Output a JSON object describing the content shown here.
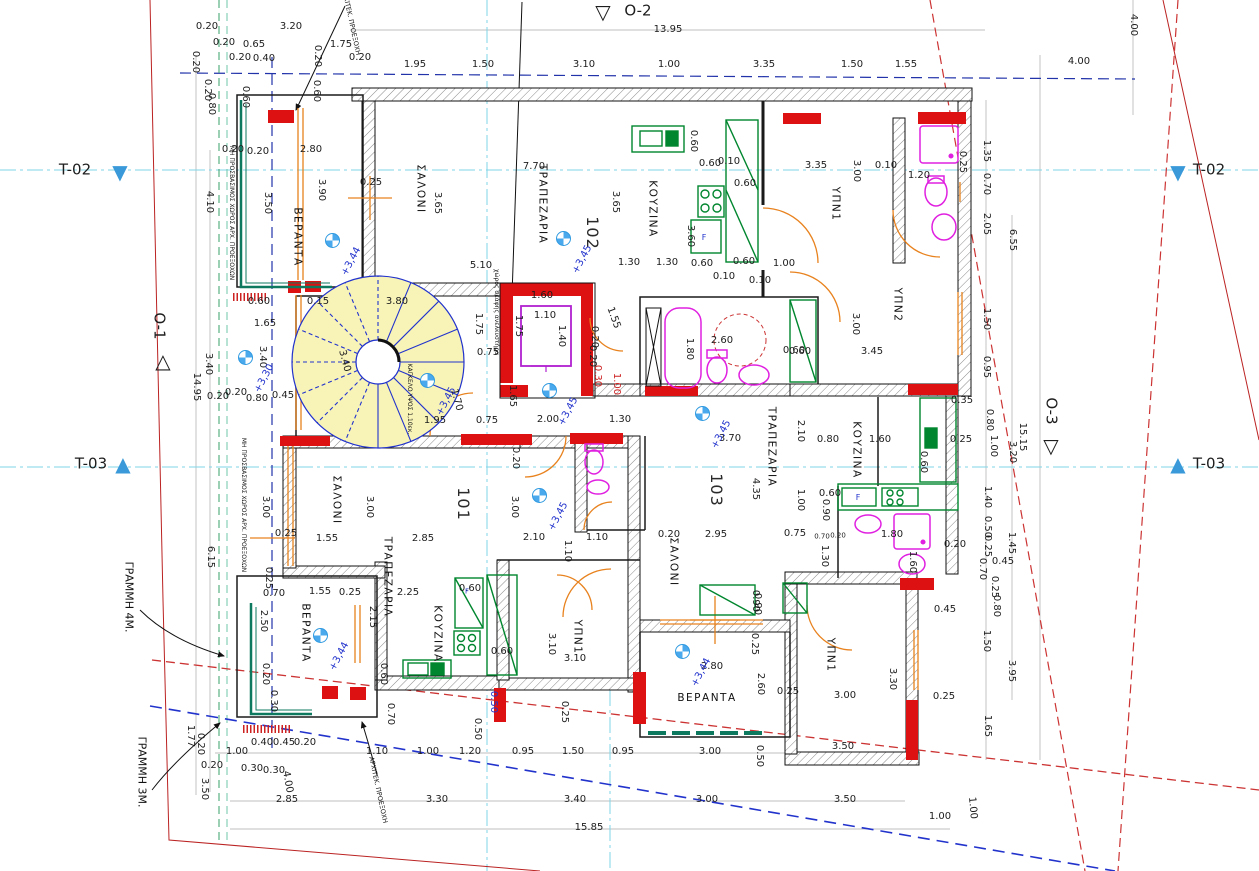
{
  "drawing": {
    "type": "architectural-floor-plan",
    "grammh_4m_label": "ΓΡΑΜΜΗ 4Μ.",
    "grammh_3m_label": "ΓΡΑΜΜΗ 3Μ."
  },
  "colors": {
    "wall_red": "#dd1111",
    "stair_yellow": "#f8f4b8",
    "stair_blue": "#2233cc",
    "fixture_magenta": "#e020e0",
    "kitchen_green": "#00862e",
    "door_orange": "#e8821e",
    "axis_cyan": "#7fd4e8",
    "boundary_red": "#cc3333",
    "line_blue": "#2233cc",
    "teal_rail": "#0d7a5f",
    "marker_blue": "#3a9ad9"
  },
  "units": [
    {
      "number": "101",
      "rooms": [
        "ΣΑΛΟΝΙ",
        "ΤΡΑΠΕΖΑΡΙΑ",
        "ΚΟΥΖΙΝΑ",
        "ΥΠΝ1",
        "ΒΕΡΑΝΤΑ"
      ]
    },
    {
      "number": "102",
      "rooms": [
        "ΒΕΡΑΝΤΑ",
        "ΣΑΛΟΝΙ",
        "ΤΡΑΠΕΖΑΡΙΑ",
        "ΚΟΥΖΙΝΑ",
        "ΥΠΝ1",
        "ΥΠΝ2"
      ]
    },
    {
      "number": "103",
      "rooms": [
        "ΣΑΛΟΝΙ",
        "ΤΡΑΠΕΖΑΡΙΑ",
        "ΚΟΥΖΙΝΑ",
        "ΥΠΝ1",
        "ΒΕΡΑΝΤΑ"
      ]
    }
  ],
  "markers": [
    {
      "t": "T-02",
      "x": 75,
      "y": 170,
      "g": "▼",
      "gx": 120,
      "gy": 172,
      "gc": "#3a9ad9"
    },
    {
      "t": "T-02",
      "x": 1209,
      "y": 170,
      "g": "▼",
      "gx": 1178,
      "gy": 172,
      "gc": "#3a9ad9"
    },
    {
      "t": "T-03",
      "x": 91,
      "y": 464,
      "g": "▲",
      "gx": 123,
      "gy": 464,
      "gc": "#3a9ad9"
    },
    {
      "t": "T-03",
      "x": 1209,
      "y": 464,
      "g": "▲",
      "gx": 1178,
      "gy": 464,
      "gc": "#3a9ad9"
    },
    {
      "t": "O-2",
      "x": 638,
      "y": 11,
      "g": "▽",
      "gx": 603,
      "gy": 12,
      "gc": "#1d1d1d"
    },
    {
      "t": "O-1",
      "x": 159,
      "y": 326,
      "r": 90,
      "g": "△",
      "gx": 163,
      "gy": 361,
      "gc": "#1d1d1d"
    },
    {
      "t": "O-3",
      "x": 1051,
      "y": 411,
      "r": 90,
      "g": "▽",
      "gx": 1051,
      "gy": 446,
      "gc": "#1d1d1d"
    }
  ],
  "unit_labels": [
    {
      "t": "102",
      "x": 592,
      "y": 233,
      "r": 90
    },
    {
      "t": "101",
      "x": 463,
      "y": 504,
      "r": 90
    },
    {
      "t": "103",
      "x": 716,
      "y": 490,
      "r": 90
    }
  ],
  "room_labels": [
    {
      "t": "ΒΕΡΑΝΤΑ",
      "x": 297,
      "y": 237,
      "r": 90
    },
    {
      "t": "ΣΑΛΟΝΙ",
      "x": 420,
      "y": 189,
      "r": 90
    },
    {
      "t": "ΤΡΑΠΕΖΑΡΙΑ",
      "x": 542,
      "y": 204,
      "r": 90
    },
    {
      "t": "ΚΟΥΖΙΝΑ",
      "x": 652,
      "y": 209,
      "r": 90
    },
    {
      "t": "ΥΠΝ1",
      "x": 835,
      "y": 204,
      "r": 90
    },
    {
      "t": "ΥΠΝ2",
      "x": 897,
      "y": 305,
      "r": 90
    },
    {
      "t": "ΣΑΛΟΝΙ",
      "x": 336,
      "y": 500,
      "r": 90
    },
    {
      "t": "ΤΡΑΠΕΖΑΡΙΑ",
      "x": 387,
      "y": 577,
      "r": 90
    },
    {
      "t": "ΚΟΥΖΙΝΑ",
      "x": 437,
      "y": 634,
      "r": 90
    },
    {
      "t": "ΥΠΝ1",
      "x": 577,
      "y": 637,
      "r": 90
    },
    {
      "t": "ΒΕΡΑΝΤΑ",
      "x": 305,
      "y": 633,
      "r": 90
    },
    {
      "t": "ΣΑΛΟΝΙ",
      "x": 673,
      "y": 562,
      "r": 90
    },
    {
      "t": "ΤΡΑΠΕΖΑΡΙΑ",
      "x": 771,
      "y": 447,
      "r": 90
    },
    {
      "t": "ΚΟΥΖΙΝΑ",
      "x": 856,
      "y": 450,
      "r": 90
    },
    {
      "t": "ΥΠΝ1",
      "x": 830,
      "y": 655,
      "r": 90
    },
    {
      "t": "ΒΕΡΑΝΤΑ",
      "x": 707,
      "y": 698
    }
  ],
  "elevation_points": [
    {
      "t": "+3,44",
      "x": 332,
      "y": 240
    },
    {
      "t": "+3,45",
      "x": 563,
      "y": 238
    },
    {
      "t": "+3,45",
      "x": 427,
      "y": 380
    },
    {
      "t": "+3,45",
      "x": 549,
      "y": 390
    },
    {
      "t": "+3,45",
      "x": 702,
      "y": 413
    },
    {
      "t": "+3,45",
      "x": 539,
      "y": 495
    },
    {
      "t": "+3,44",
      "x": 320,
      "y": 635
    },
    {
      "t": "+3,44",
      "x": 682,
      "y": 651
    },
    {
      "t": "+3,30",
      "x": 245,
      "y": 357
    }
  ],
  "notes": [
    {
      "t": "ΓΡΑΜΜΗ 4Μ.",
      "x": 129,
      "y": 597,
      "r": 90,
      "s": 11
    },
    {
      "t": "ΓΡΑΜΜΗ 3Μ.",
      "x": 142,
      "y": 772,
      "r": 90,
      "s": 11
    },
    {
      "t": "ΑΡΧΙΤΕΚ. ΠΡΟΕΞΟΧΗ",
      "x": 351,
      "y": 22,
      "r": 78,
      "s": 6.5
    },
    {
      "t": "ΑΡΧΙΤΕΚ. ΠΡΟΕΞΟΧΗ",
      "x": 378,
      "y": 790,
      "r": 78,
      "s": 6.5
    },
    {
      "t": "ΜΗ ΠΡΟΣΒΑΣΙΜΟΣ ΧΩΡΟΣ ΑΡΧ. ΠΡΟΕΞΟΧΩΝ",
      "x": 231,
      "y": 213,
      "r": 90,
      "s": 6
    },
    {
      "t": "ΜΗ ΠΡΟΣΒΑΣΙΜΟΣ ΧΩΡΟΣ ΑΡΧ. ΠΡΟΕΞΟΧΩΝ",
      "x": 243,
      "y": 505,
      "r": 90,
      "s": 6
    },
    {
      "t": "χώρος σκάφης ανελκυστήρα",
      "x": 496,
      "y": 312,
      "r": 90,
      "s": 6
    },
    {
      "t": "ΚΑΓΚΕΛΟ ΥΨΟΣ 1,10εκ.",
      "x": 409,
      "y": 399,
      "r": 90,
      "s": 6
    },
    {
      "t": "F",
      "x": 704,
      "y": 238,
      "s": 8,
      "c": "#2233cc"
    },
    {
      "t": "F",
      "x": 858,
      "y": 498,
      "s": 8,
      "c": "#2233cc"
    },
    {
      "t": "F",
      "x": 467,
      "y": 592,
      "s": 7,
      "c": "#2233cc"
    }
  ],
  "dimensions": [
    {
      "t": "13.95",
      "x": 668,
      "y": 30
    },
    {
      "t": "0.20",
      "x": 207,
      "y": 27
    },
    {
      "t": "3.20",
      "x": 291,
      "y": 27
    },
    {
      "t": "0.20",
      "x": 224,
      "y": 43
    },
    {
      "t": "0.65",
      "x": 254,
      "y": 45
    },
    {
      "t": "1.75",
      "x": 341,
      "y": 45
    },
    {
      "t": "0.20",
      "x": 240,
      "y": 58
    },
    {
      "t": "0.40",
      "x": 264,
      "y": 59
    },
    {
      "t": "0.20",
      "x": 317,
      "y": 56,
      "r": 90
    },
    {
      "t": "0.20",
      "x": 360,
      "y": 58
    },
    {
      "t": "1.95",
      "x": 415,
      "y": 65
    },
    {
      "t": "1.50",
      "x": 483,
      "y": 65
    },
    {
      "t": "3.10",
      "x": 584,
      "y": 65
    },
    {
      "t": "1.00",
      "x": 669,
      "y": 65
    },
    {
      "t": "3.35",
      "x": 764,
      "y": 65
    },
    {
      "t": "1.50",
      "x": 852,
      "y": 65
    },
    {
      "t": "1.55",
      "x": 906,
      "y": 65
    },
    {
      "t": "4.00",
      "x": 1079,
      "y": 62
    },
    {
      "t": "4.00",
      "x": 1133,
      "y": 25,
      "r": 90
    },
    {
      "t": "0.20",
      "x": 195,
      "y": 62,
      "r": 90
    },
    {
      "t": "0.20",
      "x": 207,
      "y": 90,
      "r": 90
    },
    {
      "t": "0.80",
      "x": 211,
      "y": 104,
      "r": 90
    },
    {
      "t": "0.60",
      "x": 245,
      "y": 97,
      "r": 90
    },
    {
      "t": "0.60",
      "x": 316,
      "y": 91,
      "r": 90
    },
    {
      "t": "0.20",
      "x": 233,
      "y": 150
    },
    {
      "t": "0.20",
      "x": 258,
      "y": 152
    },
    {
      "t": "2.80",
      "x": 311,
      "y": 150
    },
    {
      "t": "4.10",
      "x": 209,
      "y": 202,
      "r": 90
    },
    {
      "t": "3.50",
      "x": 267,
      "y": 203,
      "r": 90
    },
    {
      "t": "3.90",
      "x": 321,
      "y": 190,
      "r": 90
    },
    {
      "t": "0.25",
      "x": 371,
      "y": 183
    },
    {
      "t": "3.65",
      "x": 437,
      "y": 203,
      "r": 90
    },
    {
      "t": "7.70",
      "x": 534,
      "y": 167
    },
    {
      "t": "3.65",
      "x": 615,
      "y": 202,
      "r": 90
    },
    {
      "t": "3.60",
      "x": 690,
      "y": 236,
      "r": 90
    },
    {
      "t": "5.10",
      "x": 481,
      "y": 266
    },
    {
      "t": "0.60",
      "x": 710,
      "y": 164
    },
    {
      "t": "0.10",
      "x": 729,
      "y": 162
    },
    {
      "t": "0.60",
      "x": 745,
      "y": 184
    },
    {
      "t": "0.60",
      "x": 693,
      "y": 141,
      "r": 90
    },
    {
      "t": "3.35",
      "x": 816,
      "y": 166
    },
    {
      "t": "3.00",
      "x": 856,
      "y": 171,
      "r": 90
    },
    {
      "t": "0.10",
      "x": 886,
      "y": 166
    },
    {
      "t": "1.20",
      "x": 919,
      "y": 176
    },
    {
      "t": "0.25",
      "x": 962,
      "y": 162,
      "r": 90
    },
    {
      "t": "1.30",
      "x": 629,
      "y": 263
    },
    {
      "t": "1.30",
      "x": 667,
      "y": 263
    },
    {
      "t": "0.60",
      "x": 702,
      "y": 264
    },
    {
      "t": "0.60",
      "x": 744,
      "y": 262
    },
    {
      "t": "1.00",
      "x": 784,
      "y": 264
    },
    {
      "t": "0.10",
      "x": 724,
      "y": 277
    },
    {
      "t": "0.10",
      "x": 760,
      "y": 281
    },
    {
      "t": "1.35",
      "x": 986,
      "y": 151,
      "r": 90
    },
    {
      "t": "0.70",
      "x": 986,
      "y": 184,
      "r": 90
    },
    {
      "t": "2.05",
      "x": 986,
      "y": 224,
      "r": 90
    },
    {
      "t": "6.55",
      "x": 1012,
      "y": 240,
      "r": 90
    },
    {
      "t": "1.50",
      "x": 986,
      "y": 319,
      "r": 90
    },
    {
      "t": "0.95",
      "x": 986,
      "y": 367,
      "r": 90
    },
    {
      "t": "0.35",
      "x": 962,
      "y": 401
    },
    {
      "t": "0.80",
      "x": 989,
      "y": 420,
      "r": 90
    },
    {
      "t": "1.00",
      "x": 993,
      "y": 446,
      "r": 90
    },
    {
      "t": "15.15",
      "x": 1022,
      "y": 437,
      "r": 90
    },
    {
      "t": "3.20",
      "x": 1012,
      "y": 452,
      "r": 90
    },
    {
      "t": "0.15",
      "x": 318,
      "y": 302
    },
    {
      "t": "3.80",
      "x": 397,
      "y": 302
    },
    {
      "t": "3.40",
      "x": 344,
      "y": 361,
      "r": 75
    },
    {
      "t": "1.75",
      "x": 478,
      "y": 324,
      "r": 90
    },
    {
      "t": "0.75",
      "x": 488,
      "y": 353
    },
    {
      "t": "1.70",
      "x": 456,
      "y": 400,
      "r": 75
    },
    {
      "t": "1.95",
      "x": 435,
      "y": 421
    },
    {
      "t": "0.75",
      "x": 487,
      "y": 421
    },
    {
      "t": "1.65",
      "x": 512,
      "y": 396,
      "r": 90
    },
    {
      "t": "1.60",
      "x": 542,
      "y": 296
    },
    {
      "t": "1.10",
      "x": 545,
      "y": 316
    },
    {
      "t": "1.40",
      "x": 561,
      "y": 336,
      "r": 90
    },
    {
      "t": "1.75",
      "x": 518,
      "y": 326,
      "r": 90
    },
    {
      "t": "1.55",
      "x": 613,
      "y": 318,
      "r": 70
    },
    {
      "t": "0.20",
      "x": 594,
      "y": 337,
      "r": 90
    },
    {
      "t": "0.20",
      "x": 592,
      "y": 356,
      "r": 90
    },
    {
      "t": "0.30",
      "x": 597,
      "y": 376,
      "r": 90,
      "c": "#cc2222"
    },
    {
      "t": "1.00",
      "x": 616,
      "y": 384,
      "r": 90,
      "c": "#cc2222"
    },
    {
      "t": "2.00",
      "x": 548,
      "y": 420
    },
    {
      "t": "1.30",
      "x": 620,
      "y": 420
    },
    {
      "t": "0.20",
      "x": 515,
      "y": 458,
      "r": 90
    },
    {
      "t": "1.80",
      "x": 689,
      "y": 349,
      "r": 90
    },
    {
      "t": "2.60",
      "x": 722,
      "y": 341
    },
    {
      "t": "0.60",
      "x": 794,
      "y": 351
    },
    {
      "t": "3.00",
      "x": 855,
      "y": 324,
      "r": 90
    },
    {
      "t": "3.45",
      "x": 872,
      "y": 352
    },
    {
      "t": "0.60",
      "x": 800,
      "y": 352
    },
    {
      "t": "0.60",
      "x": 259,
      "y": 302
    },
    {
      "t": "1.65",
      "x": 265,
      "y": 324
    },
    {
      "t": "3.40",
      "x": 208,
      "y": 364,
      "r": 90
    },
    {
      "t": "3.40",
      "x": 262,
      "y": 357,
      "r": 90
    },
    {
      "t": "14.95",
      "x": 196,
      "y": 387,
      "r": 90
    },
    {
      "t": "0.20",
      "x": 218,
      "y": 397
    },
    {
      "t": "0.20",
      "x": 236,
      "y": 393
    },
    {
      "t": "0.80",
      "x": 257,
      "y": 399
    },
    {
      "t": "0.45",
      "x": 283,
      "y": 396
    },
    {
      "t": "6.15",
      "x": 210,
      "y": 557,
      "r": 90
    },
    {
      "t": "3.00",
      "x": 265,
      "y": 507,
      "r": 90
    },
    {
      "t": "3.00",
      "x": 369,
      "y": 507,
      "r": 90
    },
    {
      "t": "3.00",
      "x": 514,
      "y": 507,
      "r": 90
    },
    {
      "t": "0.25",
      "x": 286,
      "y": 534
    },
    {
      "t": "1.55",
      "x": 327,
      "y": 539
    },
    {
      "t": "2.85",
      "x": 423,
      "y": 539
    },
    {
      "t": "2.10",
      "x": 534,
      "y": 538
    },
    {
      "t": "1.10",
      "x": 597,
      "y": 538
    },
    {
      "t": "1.10",
      "x": 567,
      "y": 551,
      "r": 90
    },
    {
      "t": "0.25",
      "x": 268,
      "y": 578,
      "r": 90
    },
    {
      "t": "0.70",
      "x": 274,
      "y": 594
    },
    {
      "t": "1.55",
      "x": 320,
      "y": 592
    },
    {
      "t": "0.25",
      "x": 350,
      "y": 593
    },
    {
      "t": "2.25",
      "x": 408,
      "y": 593
    },
    {
      "t": "0.60",
      "x": 470,
      "y": 589
    },
    {
      "t": "3.70",
      "x": 730,
      "y": 439
    },
    {
      "t": "2.10",
      "x": 800,
      "y": 431,
      "r": 90
    },
    {
      "t": "0.80",
      "x": 828,
      "y": 440
    },
    {
      "t": "1.60",
      "x": 880,
      "y": 440
    },
    {
      "t": "0.25",
      "x": 961,
      "y": 440
    },
    {
      "t": "0.60",
      "x": 923,
      "y": 462,
      "r": 90
    },
    {
      "t": "4.35",
      "x": 755,
      "y": 489,
      "r": 90
    },
    {
      "t": "1.00",
      "x": 800,
      "y": 500,
      "r": 90
    },
    {
      "t": "0.60",
      "x": 830,
      "y": 494
    },
    {
      "t": "0.90",
      "x": 825,
      "y": 510,
      "r": 90
    },
    {
      "t": "0.20",
      "x": 669,
      "y": 535
    },
    {
      "t": "2.95",
      "x": 716,
      "y": 535
    },
    {
      "t": "0.75",
      "x": 795,
      "y": 534
    },
    {
      "t": "0.70",
      "x": 822,
      "y": 537,
      "s": 7
    },
    {
      "t": "0.20",
      "x": 838,
      "y": 536,
      "s": 7
    },
    {
      "t": "1.30",
      "x": 824,
      "y": 556,
      "r": 90
    },
    {
      "t": "1.80",
      "x": 892,
      "y": 535
    },
    {
      "t": "1.60",
      "x": 912,
      "y": 562,
      "r": 90
    },
    {
      "t": "0.20",
      "x": 955,
      "y": 545
    },
    {
      "t": "0.90",
      "x": 755,
      "y": 601,
      "r": 90
    },
    {
      "t": "0.45",
      "x": 945,
      "y": 610
    },
    {
      "t": "1.40",
      "x": 987,
      "y": 497,
      "r": 90
    },
    {
      "t": "0.50",
      "x": 987,
      "y": 527,
      "r": 90
    },
    {
      "t": "0.25",
      "x": 987,
      "y": 546,
      "r": 90
    },
    {
      "t": "1.45",
      "x": 1011,
      "y": 543,
      "r": 90
    },
    {
      "t": "0.70",
      "x": 982,
      "y": 569,
      "r": 90
    },
    {
      "t": "0.25",
      "x": 994,
      "y": 587,
      "r": 90
    },
    {
      "t": "0.80",
      "x": 996,
      "y": 606,
      "r": 90
    },
    {
      "t": "1.50",
      "x": 986,
      "y": 641,
      "r": 90
    },
    {
      "t": "3.95",
      "x": 1011,
      "y": 671,
      "r": 90
    },
    {
      "t": "1.65",
      "x": 987,
      "y": 726,
      "r": 90
    },
    {
      "t": "0.45",
      "x": 1003,
      "y": 562
    },
    {
      "t": "2.50",
      "x": 263,
      "y": 621,
      "r": 90
    },
    {
      "t": "2.15",
      "x": 372,
      "y": 617,
      "r": 90
    },
    {
      "t": "0.60",
      "x": 502,
      "y": 652
    },
    {
      "t": "0.60",
      "x": 383,
      "y": 674,
      "r": 90
    },
    {
      "t": "0.20",
      "x": 265,
      "y": 674,
      "r": 90
    },
    {
      "t": "0.30",
      "x": 273,
      "y": 701,
      "r": 90
    },
    {
      "t": "0.70",
      "x": 390,
      "y": 714,
      "r": 90
    },
    {
      "t": "0.50",
      "x": 493,
      "y": 702,
      "r": 90,
      "c": "#2233cc"
    },
    {
      "t": "3.10",
      "x": 551,
      "y": 644,
      "r": 90
    },
    {
      "t": "3.10",
      "x": 575,
      "y": 659
    },
    {
      "t": "0.25",
      "x": 564,
      "y": 712,
      "r": 90
    },
    {
      "t": "0.90",
      "x": 757,
      "y": 604,
      "r": 90
    },
    {
      "t": "0.25",
      "x": 754,
      "y": 644,
      "r": 90
    },
    {
      "t": "2.80",
      "x": 712,
      "y": 667
    },
    {
      "t": "2.60",
      "x": 760,
      "y": 684,
      "r": 90
    },
    {
      "t": "0.25",
      "x": 788,
      "y": 692
    },
    {
      "t": "3.00",
      "x": 845,
      "y": 696
    },
    {
      "t": "0.25",
      "x": 944,
      "y": 697
    },
    {
      "t": "3.30",
      "x": 892,
      "y": 679,
      "r": 90
    },
    {
      "t": "1.00",
      "x": 237,
      "y": 752
    },
    {
      "t": "0.40",
      "x": 262,
      "y": 743
    },
    {
      "t": "0.45",
      "x": 284,
      "y": 743
    },
    {
      "t": "0.20",
      "x": 305,
      "y": 743
    },
    {
      "t": "1.10",
      "x": 377,
      "y": 752
    },
    {
      "t": "1.00",
      "x": 428,
      "y": 752
    },
    {
      "t": "1.20",
      "x": 470,
      "y": 752
    },
    {
      "t": "0.50",
      "x": 477,
      "y": 729,
      "r": 90
    },
    {
      "t": "0.95",
      "x": 523,
      "y": 752
    },
    {
      "t": "1.50",
      "x": 573,
      "y": 752
    },
    {
      "t": "0.95",
      "x": 623,
      "y": 752
    },
    {
      "t": "3.00",
      "x": 710,
      "y": 752
    },
    {
      "t": "0.50",
      "x": 759,
      "y": 756,
      "r": 90
    },
    {
      "t": "3.50",
      "x": 843,
      "y": 747
    },
    {
      "t": "0.20",
      "x": 212,
      "y": 766
    },
    {
      "t": "0.30",
      "x": 252,
      "y": 769
    },
    {
      "t": "0.30",
      "x": 274,
      "y": 771
    },
    {
      "t": "4.00",
      "x": 287,
      "y": 782,
      "r": 80
    },
    {
      "t": "3.50",
      "x": 204,
      "y": 789,
      "r": 90
    },
    {
      "t": "1.77",
      "x": 190,
      "y": 736,
      "r": 90
    },
    {
      "t": "0.20",
      "x": 200,
      "y": 744,
      "r": 90
    },
    {
      "t": "2.85",
      "x": 287,
      "y": 800
    },
    {
      "t": "3.30",
      "x": 437,
      "y": 800
    },
    {
      "t": "3.40",
      "x": 575,
      "y": 800
    },
    {
      "t": "3.00",
      "x": 707,
      "y": 800
    },
    {
      "t": "3.50",
      "x": 845,
      "y": 800
    },
    {
      "t": "1.00",
      "x": 940,
      "y": 817
    },
    {
      "t": "1.00",
      "x": 972,
      "y": 808,
      "r": 85
    },
    {
      "t": "15.85",
      "x": 589,
      "y": 828
    }
  ]
}
